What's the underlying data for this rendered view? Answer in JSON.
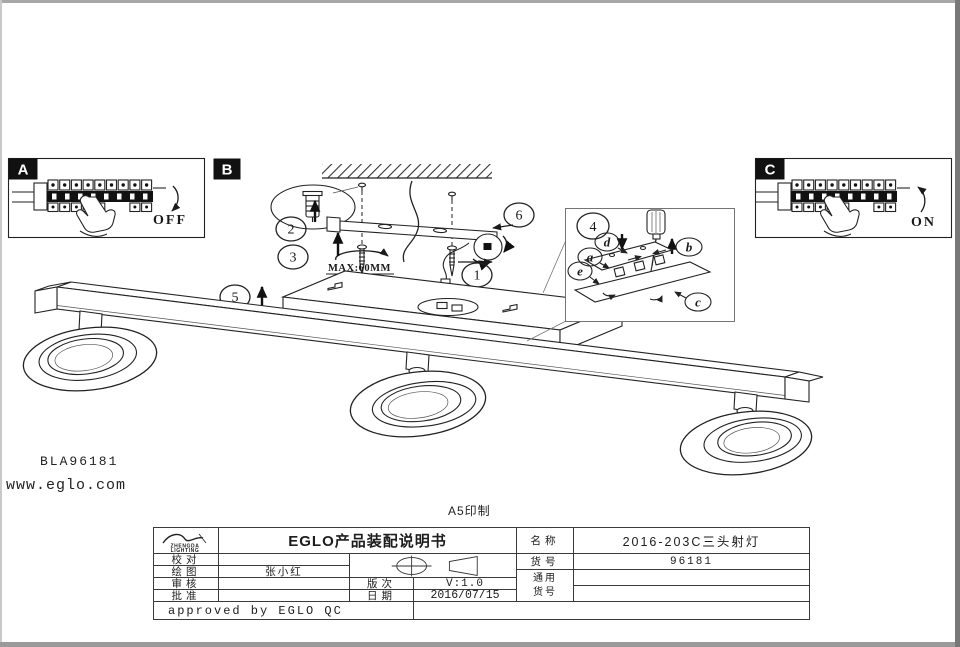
{
  "page": {
    "print_note": "A5印制",
    "product_code": "BLA96181",
    "website": "www.eglo.com"
  },
  "panel_a": {
    "label": "A",
    "switch_state": "OFF"
  },
  "panel_b": {
    "label": "B",
    "max_note": "MAX:60MM"
  },
  "panel_c": {
    "label": "C",
    "switch_state": "ON"
  },
  "steps": [
    "1",
    "2",
    "3",
    "4",
    "5",
    "6"
  ],
  "parts": [
    "a",
    "b",
    "c",
    "d",
    "e"
  ],
  "title_block": {
    "logo": {
      "line1": "ZHENGDA",
      "line2": "LIGHTING"
    },
    "doc_title": "EGLO产品装配说明书",
    "proofread_label": "校对",
    "drawn_label": "绘图",
    "drawn_by": "张小红",
    "review_label": "审核",
    "approve_label": "批准",
    "version_label": "版次",
    "version": "V:1.0",
    "date_label": "日期",
    "date": "2016/07/15",
    "approved_note": "approved by EGLO QC",
    "name_label": "名称",
    "name": "2016-203C三头射灯",
    "item_label": "货号",
    "item_no": "96181",
    "common_item_label_line1": "通用",
    "common_item_label_line2": "货号"
  }
}
